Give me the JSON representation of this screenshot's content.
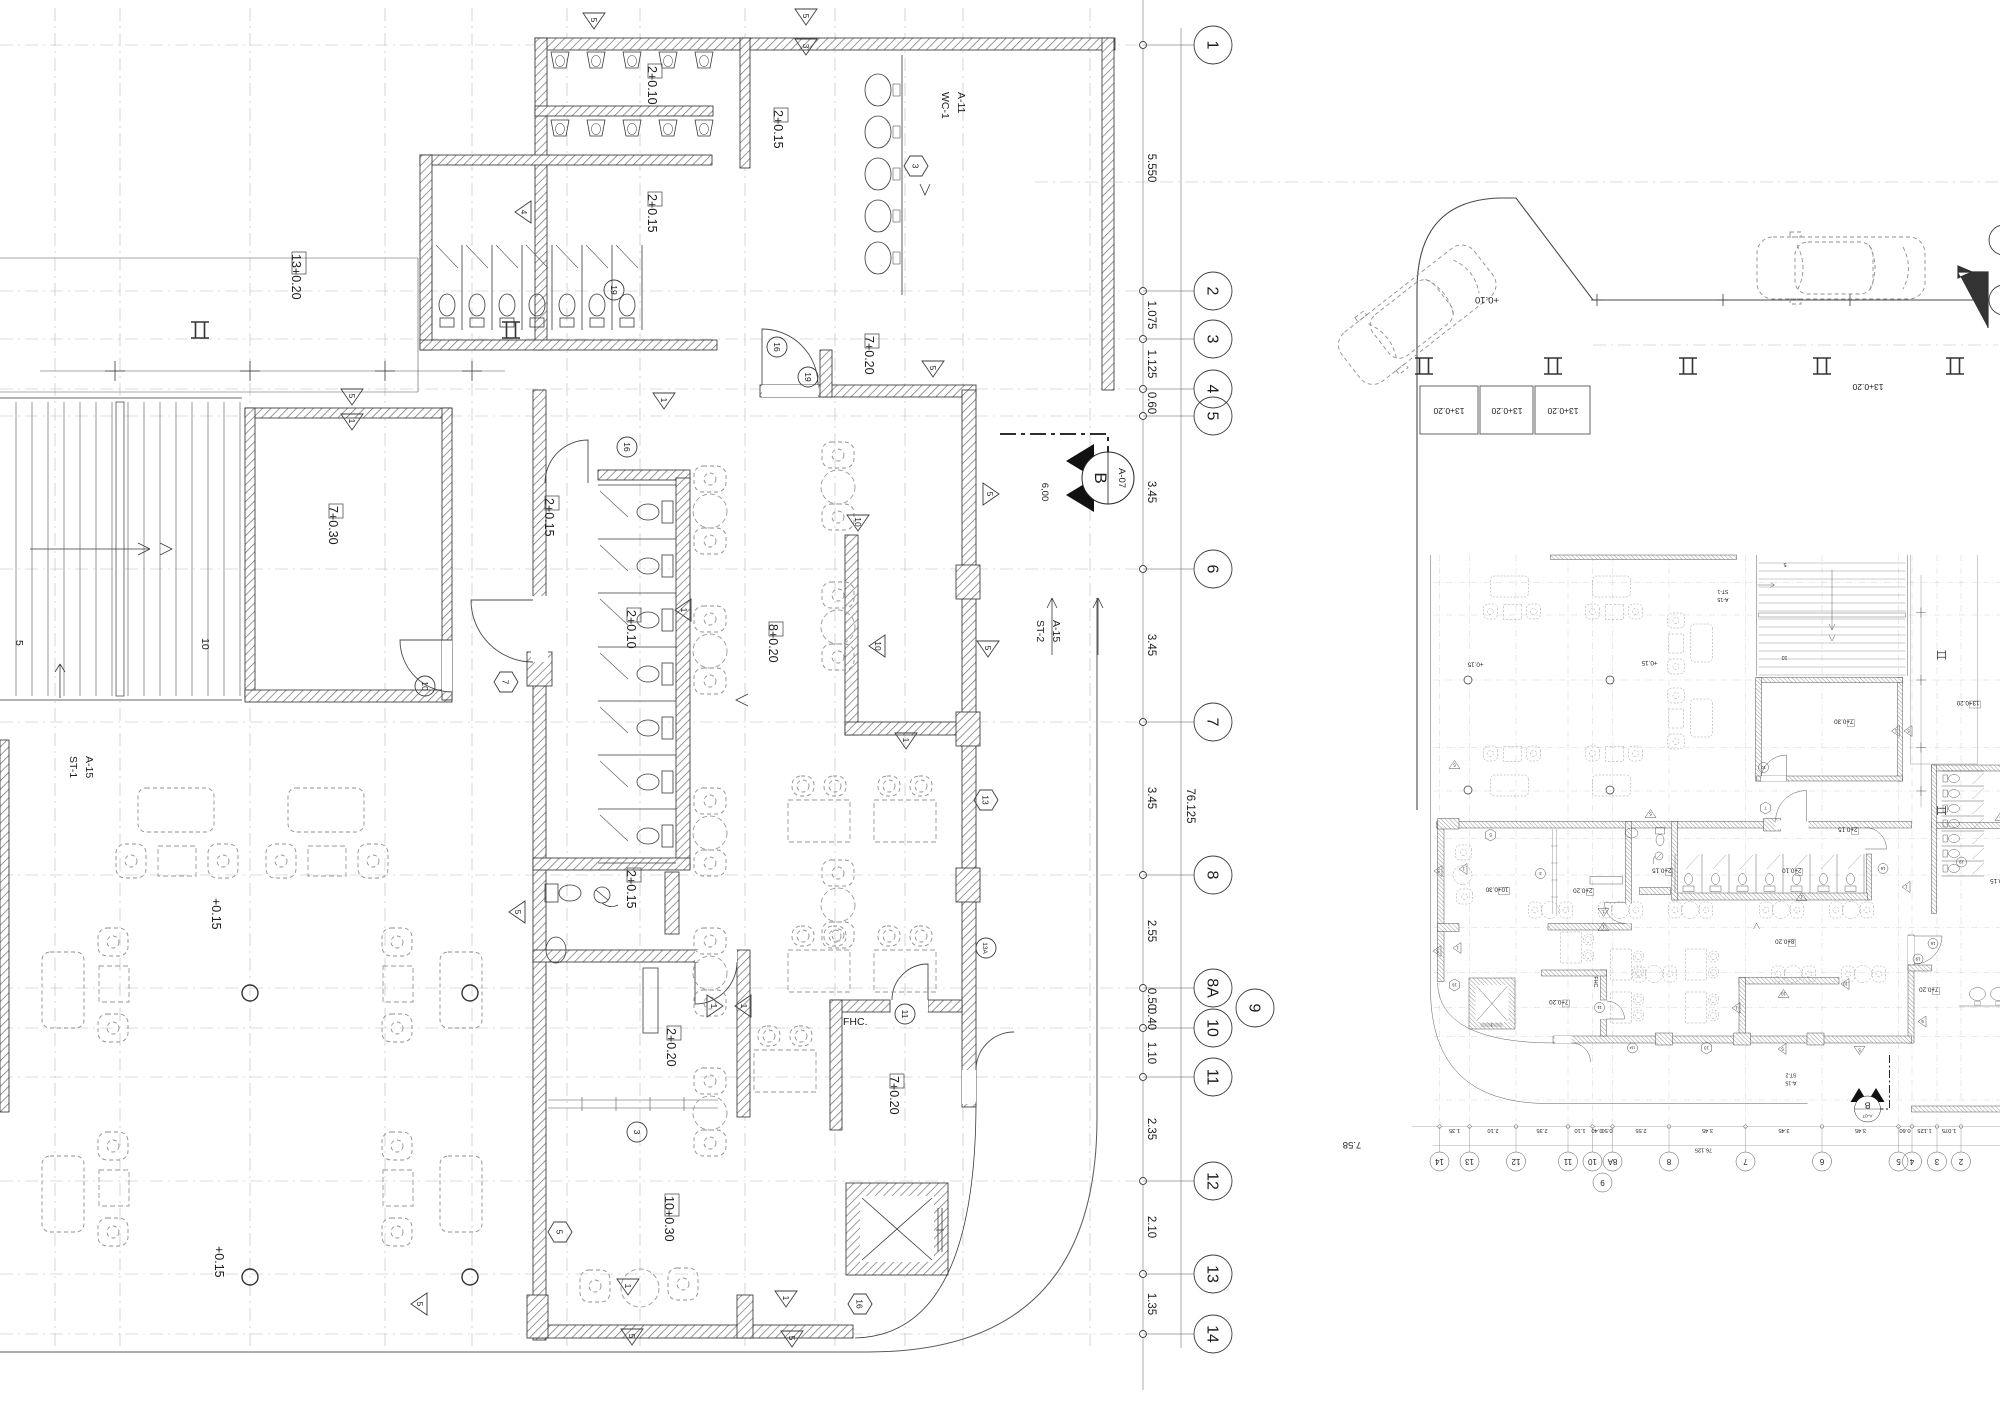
{
  "sheet": {
    "kind": "architectural floor plan",
    "plans": [
      "ground floor plan (enlarged, left)",
      "ground floor plan (overall, rotated, right)"
    ]
  },
  "plan_labels": [
    {
      "t": "2+0.10",
      "x": 652,
      "y": 66,
      "box": 1
    },
    {
      "t": "2+0.15",
      "x": 778,
      "y": 110,
      "box": 1
    },
    {
      "t": "WC-1",
      "x": 946,
      "y": 92,
      "small": 1
    },
    {
      "t": "A-11",
      "x": 962,
      "y": 92,
      "small": 1
    },
    {
      "t": "2+0.15",
      "x": 652,
      "y": 194,
      "box": 1
    },
    {
      "t": "7+0.20",
      "x": 869,
      "y": 336,
      "box": 1
    },
    {
      "t": "13+0.20",
      "x": 296,
      "y": 254,
      "box": 2
    },
    {
      "t": "7+0.30",
      "x": 333,
      "y": 506,
      "box": 1
    },
    {
      "t": "2+0.15",
      "x": 549,
      "y": 498,
      "box": 1
    },
    {
      "t": "2+0.10",
      "x": 631,
      "y": 610,
      "box": 1
    },
    {
      "t": "8+0.20",
      "x": 773,
      "y": 624,
      "box": 1
    },
    {
      "t": "ST-2",
      "x": 1041,
      "y": 620,
      "small": 1
    },
    {
      "t": "A-15",
      "x": 1057,
      "y": 620,
      "small": 1
    },
    {
      "t": "ST-1",
      "x": 74,
      "y": 756,
      "small": 1
    },
    {
      "t": "A-15",
      "x": 90,
      "y": 756,
      "small": 1
    },
    {
      "t": "+0.15",
      "x": 216,
      "y": 898
    },
    {
      "t": "2+0.15",
      "x": 631,
      "y": 870,
      "box": 1
    },
    {
      "t": "2+0.20",
      "x": 671,
      "y": 1028,
      "box": 1
    },
    {
      "t": "FHC.",
      "x": 843,
      "y": 1021,
      "r": 0,
      "small": 1
    },
    {
      "t": "7+0.20",
      "x": 894,
      "y": 1076,
      "box": 1
    },
    {
      "t": "10+0.30",
      "x": 669,
      "y": 1196,
      "box": 2
    },
    {
      "t": "+0.15",
      "x": 219,
      "y": 1246
    },
    {
      "t": "5",
      "x": 20,
      "y": 640,
      "small": 1
    },
    {
      "t": "10",
      "x": 206,
      "y": 638,
      "small": 1
    }
  ],
  "grid_column": {
    "bubble_x": 1213,
    "bubbles": [
      {
        "n": "1",
        "y": 45
      },
      {
        "n": "2",
        "y": 291
      },
      {
        "n": "3",
        "y": 339
      },
      {
        "n": "4",
        "y": 389
      },
      {
        "n": "5",
        "y": 416
      },
      {
        "n": "6",
        "y": 569
      },
      {
        "n": "7",
        "y": 722
      },
      {
        "n": "8",
        "y": 875
      },
      {
        "n": "8A",
        "y": 988
      },
      {
        "n": "10",
        "y": 1028
      },
      {
        "n": "11",
        "y": 1077
      },
      {
        "n": "12",
        "y": 1181
      },
      {
        "n": "13",
        "y": 1274
      },
      {
        "n": "14",
        "y": 1334
      }
    ],
    "offset_bubble": {
      "n": "9",
      "x": 1255,
      "y": 1008
    },
    "dim_x": 1152,
    "dims": [
      {
        "t": "5.550",
        "y": 168
      },
      {
        "t": "1.075",
        "y": 315
      },
      {
        "t": "1.125",
        "y": 364
      },
      {
        "t": "0.60",
        "y": 403
      },
      {
        "t": "3.45",
        "y": 492
      },
      {
        "t": "3.45",
        "y": 645
      },
      {
        "t": "3.45",
        "y": 798
      },
      {
        "t": "2.55",
        "y": 931
      },
      {
        "t": "0.50",
        "y": 999
      },
      {
        "t": "0.40",
        "y": 1019
      },
      {
        "t": "1.10",
        "y": 1053
      },
      {
        "t": "2.35",
        "y": 1129
      },
      {
        "t": "2.10",
        "y": 1227
      },
      {
        "t": "1.35",
        "y": 1304
      }
    ],
    "overall": {
      "t": "76.125",
      "x": 1191,
      "y": 806
    }
  },
  "markers": {
    "triangles": [
      {
        "n": "5",
        "x": 594,
        "y": 20
      },
      {
        "n": "5",
        "x": 806,
        "y": 16
      },
      {
        "n": "3",
        "x": 806,
        "y": 46
      },
      {
        "n": "4",
        "x": 524,
        "y": 212,
        "a": 90
      },
      {
        "n": "5",
        "x": 352,
        "y": 396
      },
      {
        "n": "1",
        "x": 352,
        "y": 421
      },
      {
        "n": "5",
        "x": 933,
        "y": 368
      },
      {
        "n": "1",
        "x": 664,
        "y": 400
      },
      {
        "n": "1",
        "x": 684,
        "y": 610,
        "a": 90
      },
      {
        "n": "10",
        "x": 858,
        "y": 522
      },
      {
        "n": "10",
        "x": 878,
        "y": 646,
        "a": 90
      },
      {
        "n": "1",
        "x": 906,
        "y": 740
      },
      {
        "n": "5",
        "x": 990,
        "y": 494,
        "a": 270
      },
      {
        "n": "5",
        "x": 988,
        "y": 648
      },
      {
        "n": "5",
        "x": 518,
        "y": 912,
        "a": 90
      },
      {
        "n": "1",
        "x": 744,
        "y": 1006,
        "a": 90
      },
      {
        "n": "1",
        "x": 714,
        "y": 1006,
        "a": 270
      },
      {
        "n": "1",
        "x": 628,
        "y": 1286
      },
      {
        "n": "5",
        "x": 632,
        "y": 1336
      },
      {
        "n": "1",
        "x": 786,
        "y": 1298
      },
      {
        "n": "5",
        "x": 792,
        "y": 1338
      },
      {
        "n": "5",
        "x": 420,
        "y": 1304,
        "a": 90
      }
    ],
    "hexagons": [
      {
        "n": "3",
        "x": 916,
        "y": 166
      },
      {
        "n": "7",
        "x": 506,
        "y": 682
      },
      {
        "n": "5",
        "x": 560,
        "y": 1232
      },
      {
        "n": "16",
        "x": 860,
        "y": 1304
      },
      {
        "n": "13",
        "x": 986,
        "y": 800
      }
    ],
    "circles": [
      {
        "n": "16",
        "x": 777,
        "y": 347
      },
      {
        "n": "19",
        "x": 808,
        "y": 377
      },
      {
        "n": "19",
        "x": 614,
        "y": 290
      },
      {
        "n": "10",
        "x": 425,
        "y": 686
      },
      {
        "n": "3",
        "x": 637,
        "y": 1132
      },
      {
        "n": "11",
        "x": 905,
        "y": 1014
      },
      {
        "n": "13A",
        "x": 986,
        "y": 948
      },
      {
        "n": "16",
        "x": 627,
        "y": 447
      }
    ]
  },
  "section_marker": {
    "letter": "B",
    "sheet_ref": "A-07",
    "x": 1108,
    "y": 478
  },
  "site": {
    "labels": [
      {
        "t": "13+0.20",
        "x": 1449,
        "y": 412,
        "r": 180
      },
      {
        "t": "13+0.20",
        "x": 1507,
        "y": 412,
        "r": 180
      },
      {
        "t": "13+0.20",
        "x": 1563,
        "y": 412,
        "r": 180
      },
      {
        "t": "13+0.20",
        "x": 1868,
        "y": 388,
        "r": 180
      },
      {
        "t": "+0.10",
        "x": 1487,
        "y": 301,
        "r": 180
      },
      {
        "t": "7.58",
        "x": 1352,
        "y": 1146,
        "r": 180
      },
      {
        "t": "6,00",
        "x": 1046,
        "y": 492,
        "r": 90
      }
    ],
    "cars": [
      {
        "x": 1332,
        "y": 342,
        "rot": -38
      },
      {
        "x": 1757,
        "y": 237,
        "rot": 0
      }
    ],
    "parking_stalls": [
      [
        1420,
        386,
        58,
        48
      ],
      [
        1480,
        386,
        53,
        48
      ],
      [
        1535,
        386,
        55,
        48
      ]
    ],
    "ibeam_xs": [
      1424,
      1553,
      1688,
      1822,
      1955
    ],
    "ibeam_y": 366
  }
}
